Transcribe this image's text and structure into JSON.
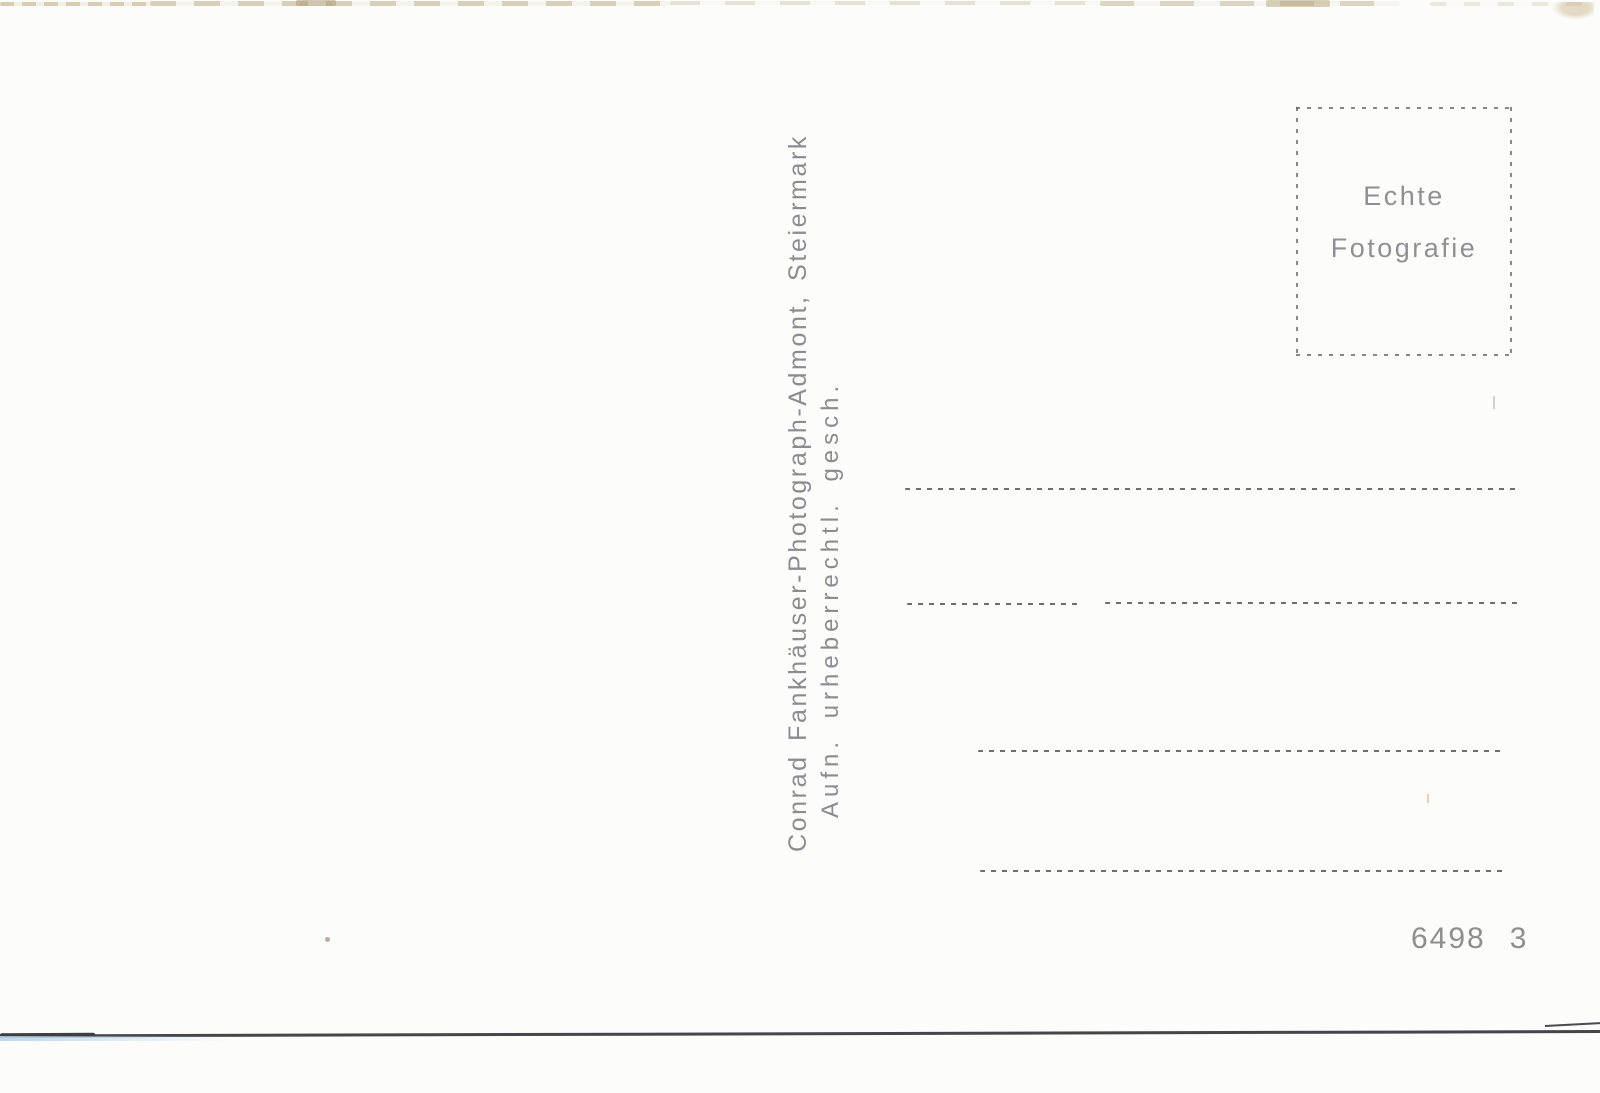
{
  "imprint": {
    "line1": "Conrad Fankhäuser-Photograph-Admont, Steiermark",
    "line2": "Aufn. urheberrechtl. gesch."
  },
  "stamp_box": {
    "line1": "Echte",
    "line2": "Fotografie"
  },
  "footer": {
    "catalog_number": "6498",
    "series_number": "3"
  },
  "layout": {
    "address_line_count": 4
  },
  "colors": {
    "card_background": "#fcfcfa",
    "imprint_ink": "#73737a",
    "stamp_ink": "#76767b",
    "rule_ink": "#4a4a48",
    "number_ink": "#8e8e8c",
    "bottom_edge": "#45454a",
    "edge_tint_blue": "#cfe2ee",
    "scan_artifact_tan": "#c7b996"
  }
}
